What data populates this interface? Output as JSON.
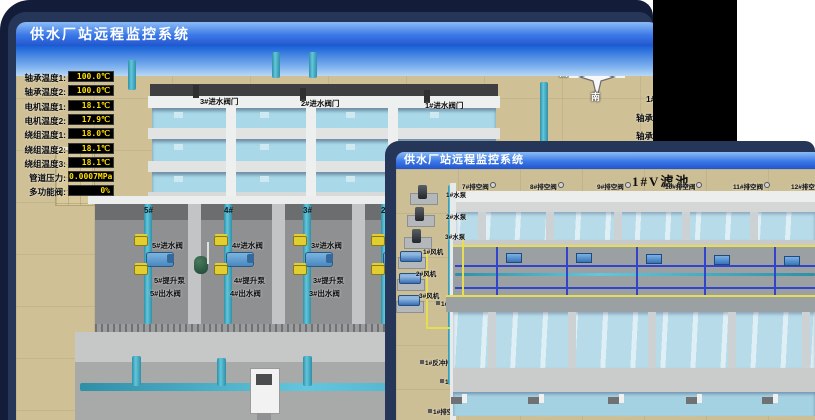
{
  "colors": {
    "frame_navy": "#263659",
    "desktop_navy": "#131d3a",
    "titlebar_blue": "#2f6de0",
    "led_text": "#ffdf00",
    "ground_tan": "#cfc096",
    "water_blue": "#a9d9e8",
    "pipe_cyan": "#49b4cc",
    "valve_yellow": "#e3ce32",
    "alarm_red": "#d43020"
  },
  "back_window": {
    "title": "供水厂站远程监控系统",
    "scene_title": "取水泵房",
    "pump_panel": {
      "header": "5#泵",
      "rows": [
        {
          "label": "轴承温度1:",
          "value": "100.0℃"
        },
        {
          "label": "轴承温度2:",
          "value": "100.0℃"
        },
        {
          "label": "电机温度1:",
          "value": "18.1℃"
        },
        {
          "label": "电机温度2:",
          "value": "17.9℃"
        },
        {
          "label": "绕组温度1:",
          "value": "18.0℃"
        },
        {
          "label": "绕组温度2:",
          "value": "18.1℃"
        },
        {
          "label": "绕组温度3:",
          "value": "18.1℃"
        },
        {
          "label": "管道压力:",
          "value": "0.0007MPa"
        },
        {
          "label": "多功能阀:",
          "value": "0%"
        }
      ]
    },
    "compass": {
      "north": "北",
      "west": "西",
      "south": "南"
    },
    "right_panel": {
      "header": "1#",
      "rows": [
        "轴承温度1:",
        "轴承温度2:"
      ]
    },
    "intake_valve_labels": [
      "3#进水阀门",
      "2#进水阀门",
      "1#进水阀门"
    ],
    "bay_numbers": [
      "5#",
      "4#",
      "3#",
      "2#"
    ],
    "bays": [
      {
        "inlet": "5#进水阀",
        "pump": "5#提升泵",
        "outlet": "5#出水阀"
      },
      {
        "inlet": "4#进水阀",
        "pump": "4#提升泵",
        "outlet": "4#出水阀"
      },
      {
        "inlet": "3#进水阀",
        "pump": "3#提升泵",
        "outlet": "3#出水阀"
      }
    ],
    "current_left": {
      "label": "4#泵电流:",
      "value": "00.0 A"
    },
    "current_right": {
      "label": "2#泵电流:"
    },
    "flow_left": {
      "label": "1#瞬时流量:",
      "value": "0.0 m3/h"
    },
    "flow_right": {
      "label": "1#瞬时流量:",
      "value": "0.0 m3/h"
    }
  },
  "front_window": {
    "title": "供水厂站远程监控系统",
    "scene_title": "1#V滤池",
    "equipment": [
      "1#水泵",
      "2#水泵",
      "3#水泵",
      "1#风机",
      "2#风机",
      "3#风机"
    ],
    "upper_cells": {
      "drain_empty": [
        "7#排空阀",
        "8#排空阀",
        "9#排空阀",
        "10#排空阀",
        "11#排空阀",
        "12#排空阀"
      ],
      "inlet": [
        "7#进水阀",
        "8#进水阀",
        "9#进水阀",
        "10#进水阀",
        "11#进水阀"
      ],
      "backwash_drain": [
        "7#反冲排水阀",
        "8#反冲排水阀",
        "9#反冲排水阀",
        "10#反冲排水阀",
        "11#反冲排水阀"
      ]
    },
    "gallery": {
      "upper_air_edge": [
        "7#反冲排气阀",
        "8#反冲排气阀",
        "9#反冲排气阀",
        "10#反冲排气阀",
        "11#反冲排气阀",
        "12#反冲排气阀"
      ],
      "upper_air": [
        "7#排气阀",
        "8#排气阀",
        "9#排气阀",
        "10#排气阀",
        "11#排气阀"
      ],
      "upper_backwash_inlet": [
        "7#反冲进水阀",
        "8#反冲进水阀",
        "9#反冲进水阀",
        "10#反冲进水阀",
        "11#反冲进水阀"
      ],
      "lower_backwash_inlet": [
        "1#反冲进水阀",
        "2#反冲进水阀",
        "3#反冲进水阀",
        "4#反冲进水阀",
        "5#反冲进水阀"
      ],
      "clean_water": [
        "1#清水阀",
        "2#清水阀",
        "3#清水阀",
        "4#清水阀",
        "5#清水阀"
      ],
      "lower_air_edge": [
        "1#反冲排气阀",
        "2#反冲排气阀",
        "3#反冲排气阀",
        "4#反冲排气阀",
        "5#反冲排气阀"
      ],
      "lower_air": [
        "1#排气阀",
        "2#排气阀",
        "3#排气阀",
        "4#排气阀",
        "5#排气阀"
      ]
    },
    "lower_cells": {
      "backwash_drain": [
        "1#反冲排水阀",
        "2#反冲排水阀",
        "3#反冲排水阀",
        "4#反冲排水阀",
        "5#反冲排水阀"
      ],
      "inlet": [
        "1#进水阀",
        "2#进水阀",
        "3#进水阀",
        "4#进水阀",
        "5#进水阀"
      ],
      "drain_empty": [
        "1#排空阀",
        "2#排空阀",
        "3#排空阀",
        "4#排空阀",
        "5#排空阀"
      ]
    }
  }
}
